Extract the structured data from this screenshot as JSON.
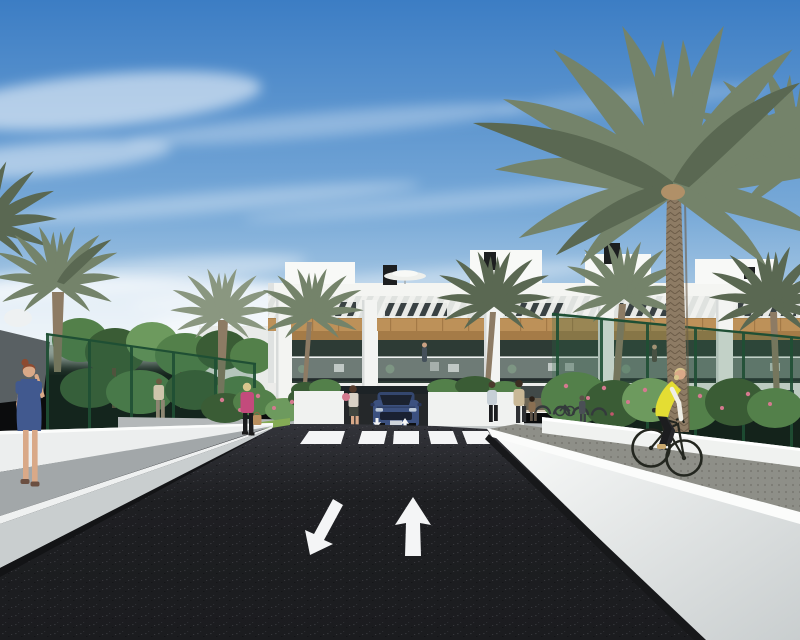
{
  "scene": {
    "title": "Architectural render: modern white apartment complex with palm trees, asphalt access road with lane arrows, zebra crosswalk, pedestrians and a cyclist",
    "objects": [
      {
        "name": "apartment-building",
        "description": "Two-storey white apartment block with wood cladding band, slatted pergola roof terraces and glass balconies"
      },
      {
        "name": "road",
        "description": "Dark asphalt two-way road with white painted lane arrows"
      },
      {
        "name": "crosswalk",
        "description": "White zebra crossing in front of the driveway"
      },
      {
        "name": "suv-car",
        "description": "Dark blue SUV parked at the garage driveway entrance"
      },
      {
        "name": "cyclist",
        "description": "Cyclist in yellow hi-vis vest riding the right-hand path"
      },
      {
        "name": "person-blue-dress",
        "description": "Red-haired woman in a blue dress on the left sidewalk, phone to ear"
      },
      {
        "name": "person-pink-jacket",
        "description": "Blonde woman in a pink jacket with tan handbag"
      },
      {
        "name": "pedestrians",
        "description": "Residents walking near the building entrance"
      },
      {
        "name": "palm-trees",
        "description": "Tall date palms around the complex"
      },
      {
        "name": "green-fence",
        "description": "Green mesh boundary fencing"
      },
      {
        "name": "white-walls",
        "description": "Low white boundary walls flanking the road"
      },
      {
        "name": "bike-racks",
        "description": "Hoop bicycle racks beside the entrance"
      },
      {
        "name": "sky",
        "description": "Blue sky with thin streaked clouds and horizon haze"
      }
    ]
  },
  "colors": {
    "sky_top": "#3c7dc4",
    "sky_mid": "#79aad8",
    "sky_low": "#c2d9ea",
    "cloud": "#ffffff",
    "building_white": "#f4f5f2",
    "parapet": "#f8f9f7",
    "window_dark": "#232b2e",
    "wood": "#bd9159",
    "wood_dark": "#a57b47",
    "balcony_interior": "#2d3b35",
    "railing_glass": "#c9d4d1",
    "building_base": "#ececea",
    "garage_dark": "#1d2326",
    "road": "#1e1f22",
    "road_top": "#33343a",
    "marking_white": "#f4f5f6",
    "sidewalk": "#b4b8b9",
    "walkway": "#a2a7a9",
    "wall_face": "#eceeee",
    "wall_bright": "#fbfcfb",
    "wall_shade": "#c9cecf",
    "curb_shadow": "#131416",
    "path_gray": "#8e8f88",
    "lawn": "#85ab55",
    "tree_green": "#53804a",
    "tree_dark": "#3a5c35",
    "tree_light": "#6d9a5e",
    "palm_green": "#74836a",
    "palm_dark": "#5a6852",
    "palm_light": "#8a9780",
    "palm_trunk": "#8d7b64",
    "palm_bark": "#6c5c48",
    "fence_green": "#2e6847",
    "fence_dark": "#1f4f34",
    "flower_pink": "#d4798f",
    "car_blue": "#3c5180",
    "car_glass": "#1b2230",
    "vest_yellow": "#e4dd33",
    "sleeve_white": "#efeee6",
    "pants_dark": "#1c1d1f",
    "skin": "#d9a988",
    "hair_red": "#8d4a30",
    "hair_blonde": "#d8c68c",
    "dress_blue": "#41598f",
    "jacket_pink": "#c34b7c",
    "bag_tan": "#b98f5e",
    "shirt_beige": "#cfc5ab",
    "top_light": "#c6cfd6",
    "bike_dark": "#23261f",
    "planter_white": "#f0f2f0"
  }
}
